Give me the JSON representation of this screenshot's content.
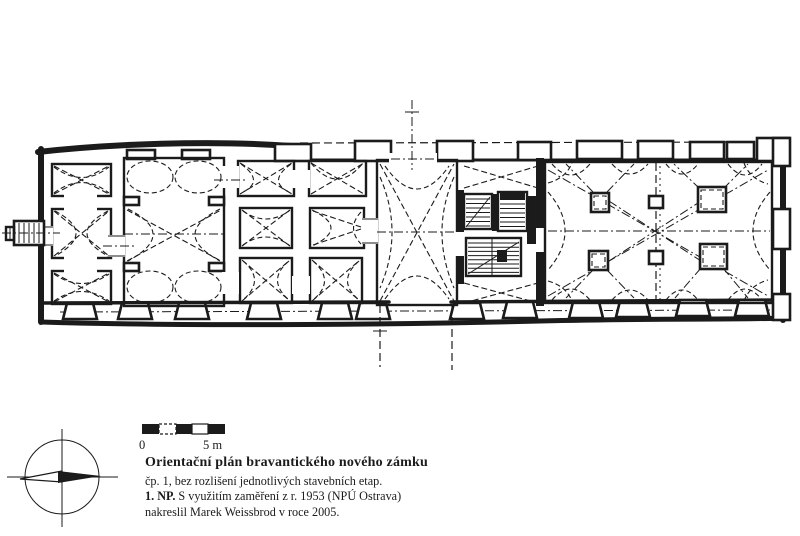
{
  "meta": {
    "kind": "scanned architectural floor plan",
    "ink_color": "#1b1b1b",
    "paper_color": "#ffffff"
  },
  "drawing": {
    "icons": {
      "compass": "compass-rose-icon",
      "north_needle": "north-needle-icon"
    },
    "scale_bar": {
      "zero_label": "0",
      "end_label": "5 m"
    }
  },
  "caption": {
    "title": "Orientační plán bravantického nového zámku",
    "line1": "čp. 1, bez rozlišení jednotlivých stavebních etap.",
    "line2_prefix": "1. NP.",
    "line2_rest": " S využitím zaměření z r. 1953 (NPÚ Ostrava)",
    "line3": "nakreslil Marek Weissbrod v roce 2005."
  }
}
